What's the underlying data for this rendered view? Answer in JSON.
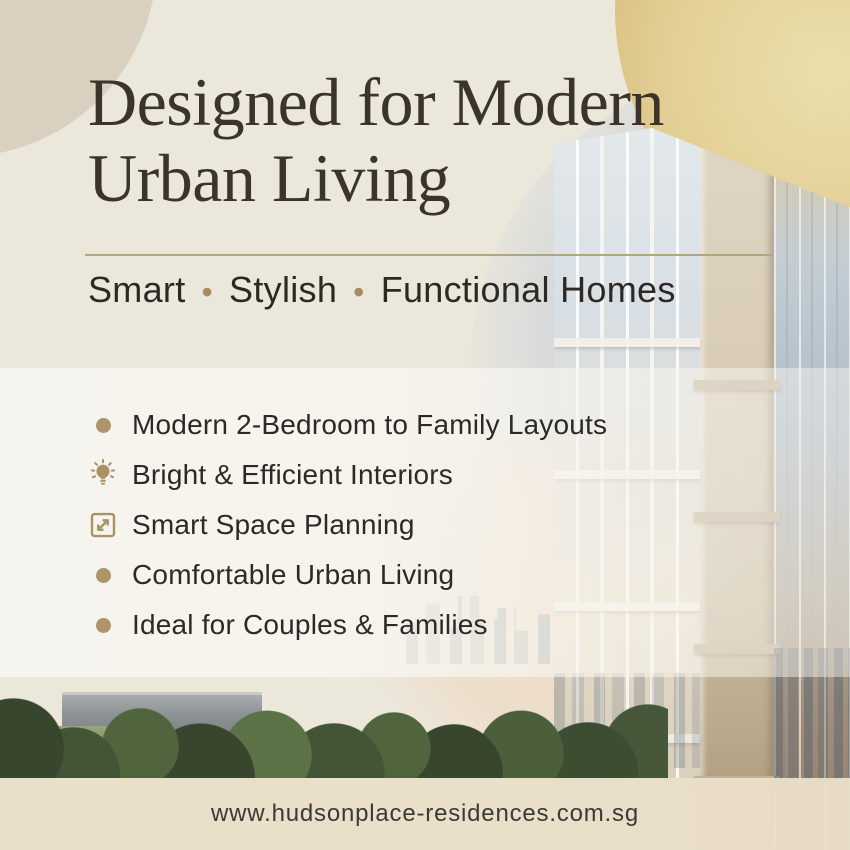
{
  "page": {
    "background_color": "#ECE7DB",
    "accent_gold": "#AE9569",
    "title_color": "#3A342C",
    "body_text_color": "#2B2A27",
    "footer_strip_color": "#E9DEC8"
  },
  "header": {
    "title_line1": "Designed for Modern",
    "title_line2": "Urban Living",
    "subtitle": {
      "word1": "Smart",
      "separator1": "•",
      "word2": "Stylish",
      "separator2": "•",
      "word3": "Functional Homes"
    }
  },
  "features": {
    "items": [
      {
        "icon": "bullet-dot",
        "label": "Modern 2-Bedroom to Family Layouts"
      },
      {
        "icon": "lightbulb",
        "label": "Bright & Efficient Interiors"
      },
      {
        "icon": "expand-arrows",
        "label": "Smart Space Planning"
      },
      {
        "icon": "bullet-dot",
        "label": "Comfortable Urban Living"
      },
      {
        "icon": "bullet-dot",
        "label": "Ideal for Couples & Families"
      }
    ]
  },
  "footer": {
    "website_url": "www.hudsonplace-residences.com.sg"
  }
}
